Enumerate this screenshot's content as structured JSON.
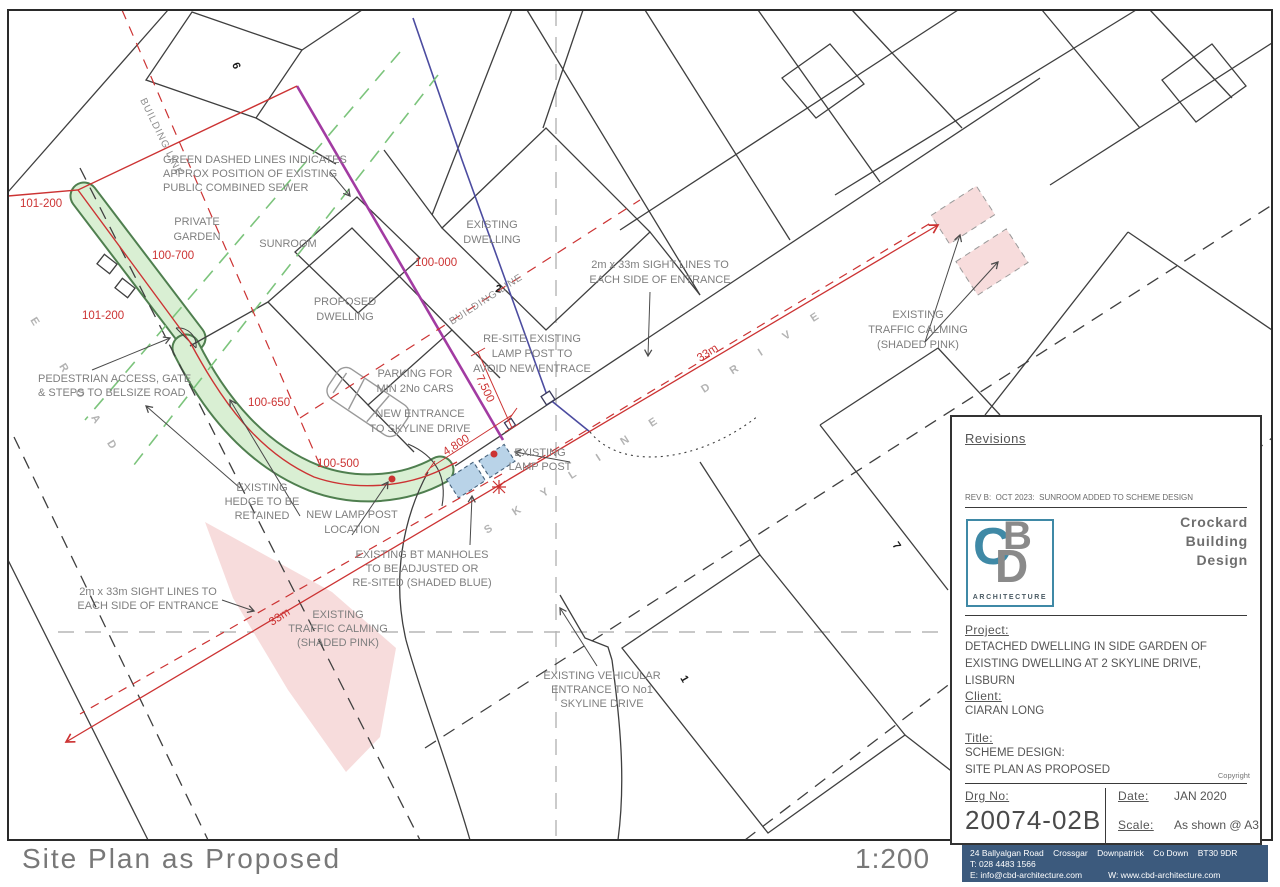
{
  "caption": {
    "title": "Site Plan as Proposed",
    "scale": "1:200"
  },
  "streets": {
    "skyline_drive": "SKYLINE DRIVE",
    "belsize_road": "E ROAD"
  },
  "house_numbers": {
    "no6": "6",
    "no2": "2",
    "no7": "7",
    "no1": "1"
  },
  "building_line": "BUILDING LINE",
  "levels": {
    "top_101_200": "101-200",
    "mid_101_200": "101-200",
    "l100_700": "100-700",
    "l100_650": "100-650",
    "l100_000": "100-000",
    "l100_500": "100-500"
  },
  "dimensions": {
    "d7500": "7,500",
    "d4800": "4,800",
    "d33m": "33m"
  },
  "annotations": {
    "sewer_note": [
      "GREEN DASHED LINES INDICATES",
      "APPROX POSITION OF EXISTING",
      "PUBLIC COMBINED SEWER"
    ],
    "private_garden": [
      "PRIVATE",
      "GARDEN"
    ],
    "sunroom": "SUNROOM",
    "proposed_dwelling": [
      "PROPOSED",
      "DWELLING"
    ],
    "existing_dwelling": [
      "EXISTING",
      "DWELLING"
    ],
    "sight_lines": [
      "2m x 33m SIGHT LINES TO",
      "EACH SIDE OF ENTRANCE"
    ],
    "resite_lamp": [
      "RE-SITE EXISTING",
      "LAMP POST TO",
      "AVOID NEW ENTRACE"
    ],
    "traffic_calming": [
      "EXISTING",
      "TRAFFIC CALMING",
      "(SHADED PINK)"
    ],
    "pedestrian_access": [
      "PEDESTRIAN ACCESS, GATE",
      "& STEPS TO BELSIZE ROAD"
    ],
    "parking": [
      "PARKING FOR",
      "MIN 2No CARS"
    ],
    "new_entrance": [
      "NEW ENTRANCE",
      "TO SKYLINE DRIVE"
    ],
    "existing_lamp": [
      "EXISTING",
      "LAMP POST"
    ],
    "existing_hedge": [
      "EXISTING",
      "HEDGE TO BE",
      "RETAINED"
    ],
    "new_lamp": [
      "NEW LAMP POST",
      "LOCATION"
    ],
    "bt_manholes": [
      "EXISTING BT MANHOLES",
      "TO BE ADJUSTED OR",
      "RE-SITED (SHADED BLUE)"
    ],
    "vehicular_entrance": [
      "EXISTING VEHICULAR",
      "ENTRANCE TO No1",
      "SKYLINE DRIVE"
    ]
  },
  "title_block": {
    "revisions_label": "Revisions",
    "revision_note": "REV B:  OCT 2023:  SUNROOM ADDED TO SCHEME DESIGN",
    "company_name": [
      "Crockard",
      "Building",
      "Design"
    ],
    "logo": {
      "c": "C",
      "b": "B",
      "d": "D",
      "sub": "ARCHITECTURE"
    },
    "project_label": "Project:",
    "project_lines": [
      "DETACHED DWELLING IN SIDE GARDEN OF",
      "EXISTING DWELLING AT 2 SKYLINE DRIVE,",
      "LISBURN"
    ],
    "client_label": "Client:",
    "client": "CIARAN LONG",
    "title_label": "Title:",
    "title_lines": [
      "SCHEME DESIGN:",
      "SITE PLAN AS PROPOSED"
    ],
    "copyright": "Copyright",
    "drg_no_label": "Drg No:",
    "drg_no": "20074-02B",
    "date_label": "Date:",
    "date": "JAN 2020",
    "scale_label": "Scale:",
    "scale": "As shown @ A3",
    "address_bar": {
      "line1": "24 Ballyalgan Road    Crossgar    Downpatrick    Co Down    BT30 9DR",
      "line2": "T: 028 4483 1566",
      "line3_e": "E: info@cbd-architecture.com",
      "line3_w": "W: www.cbd-architecture.com"
    }
  },
  "colors": {
    "red": "#cc3333",
    "purple": "#a23ba2",
    "service_blue": "#4c4ca0",
    "sewer_green": "#7cc47c",
    "hedge_fill": "#d9efd3",
    "pink_fill": "#f7dcdc",
    "manhole_blue": "#b9d3e8",
    "bar_blue": "#3c5a7d",
    "logo_teal": "#3f89a6"
  }
}
